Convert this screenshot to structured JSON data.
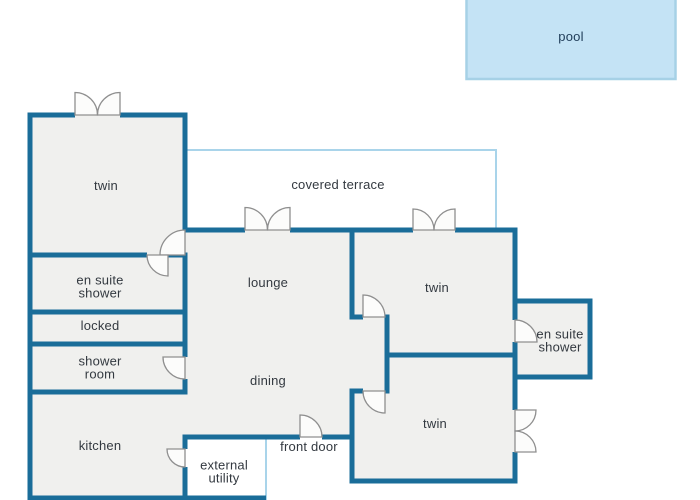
{
  "labels": {
    "pool": "pool",
    "covered_terrace": "covered terrace",
    "twin_top_left": "twin",
    "en_suite_shower_left": {
      "line1": "en suite",
      "line2": "shower"
    },
    "locked": "locked",
    "shower_room": {
      "line1": "shower",
      "line2": "room"
    },
    "kitchen": "kitchen",
    "lounge": "lounge",
    "dining": "dining",
    "front_door": "front door",
    "external_utility": {
      "line1": "external",
      "line2": "utility"
    },
    "twin_right_top": "twin",
    "en_suite_shower_right": {
      "line1": "en suite",
      "line2": "shower"
    },
    "twin_right_bottom": "twin"
  },
  "colors": {
    "wall": "#1a6d99",
    "room_fill": "#f0f0ee",
    "terrace_line": "#a9d4ea",
    "pool_fill": "#c4e3f5",
    "pool_border": "#a6d1e6",
    "door_line": "#8f8f8f",
    "text": "#333940",
    "pool_text": "#1f3c58"
  }
}
